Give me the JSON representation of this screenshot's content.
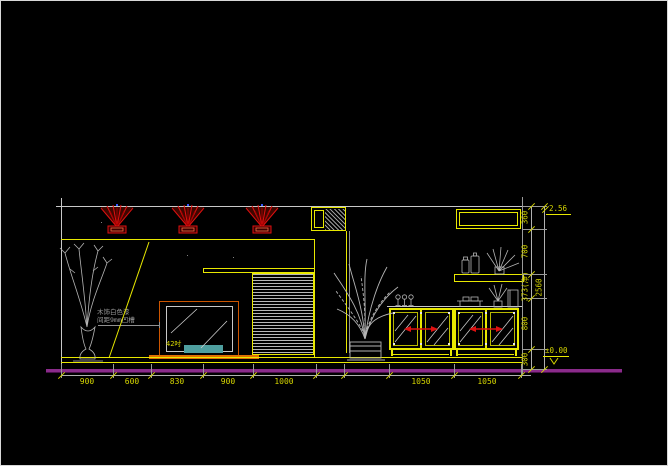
{
  "dims": {
    "bottom": [
      "900",
      "600",
      "830",
      "900",
      "1000",
      "1050",
      "1050"
    ],
    "right_segments": [
      "360",
      "700",
      "373(净)",
      "800",
      "300"
    ],
    "right_overall": "2560",
    "level_top": "2.56",
    "level_floor": "±0.00"
  },
  "notes": {
    "material_line1": "木饰白色漆",
    "material_line2": "间距9mm凹槽",
    "tv_size_label": "42吋"
  },
  "symbols": {
    "downlight": "ceiling-downlight-beam-icon",
    "left_plant": "vase-plant-icon",
    "center_plant": "palm-plant-icon",
    "shelf_plant": "shelf-plant-icon",
    "cabinet_handle": "red-door-swing-arrow-icon",
    "floor_level_mark": "level-triangle-icon"
  },
  "colors": {
    "background": "#000000",
    "line_yellow": "#e8e800",
    "line_white": "#c8c8c8",
    "beam_red": "#e01010",
    "tv_base_orange": "#e07000",
    "tv_screen_teal": "#4f9f9f",
    "floor_magenta": "#8a2b8a",
    "dim_text_yellow": "#d6d600",
    "decor_gray": "#b4b4b4"
  }
}
